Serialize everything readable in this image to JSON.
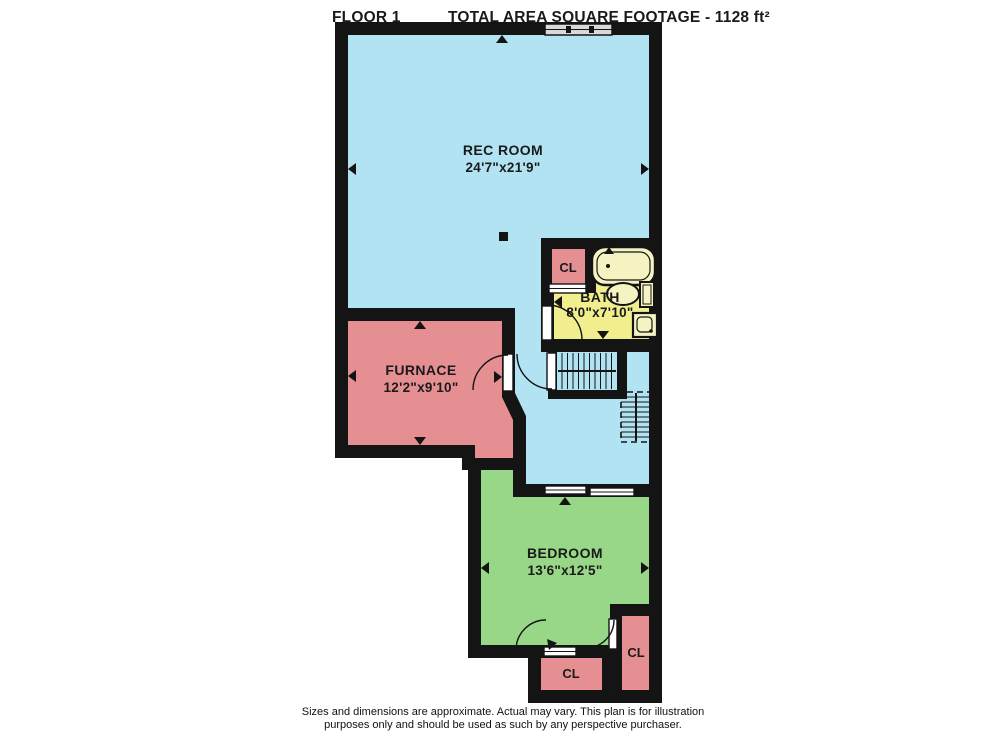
{
  "header": {
    "floor_label": "FLOOR 1",
    "area_label": "TOTAL AREA SQUARE FOOTAGE - 1128 ft²"
  },
  "rooms": {
    "rec_room": {
      "name": "REC ROOM",
      "dims": "24'7\"x21'9\""
    },
    "furnace": {
      "name": "FURNACE",
      "dims": "12'2\"x9'10\""
    },
    "bath": {
      "name": "BATH",
      "dims": "8'0\"x7'10\""
    },
    "bedroom": {
      "name": "BEDROOM",
      "dims": "13'6\"x12'5\""
    },
    "closet_bath": {
      "name": "CL"
    },
    "closet_bottom": {
      "name": "CL"
    },
    "closet_right": {
      "name": "CL"
    }
  },
  "colors": {
    "rec_room": "#b2e3f2",
    "furnace": "#e68f93",
    "bath": "#f1ee8e",
    "bedroom": "#97d787",
    "closet": "#e68f93",
    "wall": "#141414",
    "window": "#d9d9d9"
  },
  "footer": {
    "line1": "Sizes and dimensions are approximate. Actual may vary. This plan is for illustration",
    "line2": "purposes only and should be used as such by any perspective purchaser."
  }
}
